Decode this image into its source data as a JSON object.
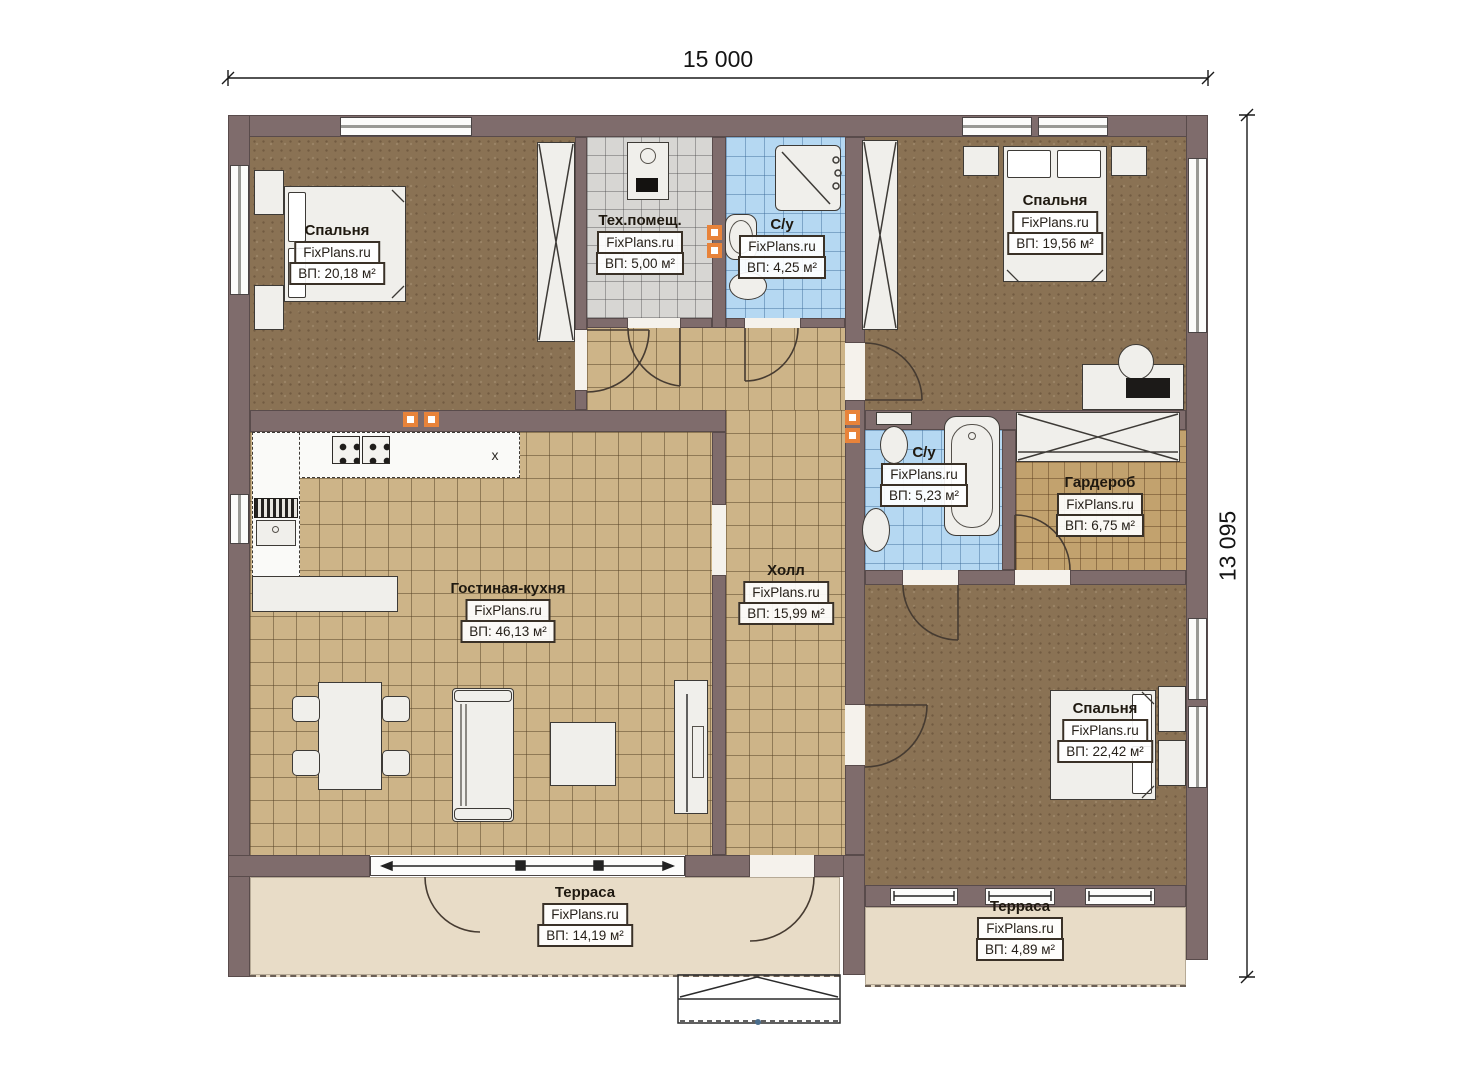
{
  "dimensions": {
    "width_label": "15 000",
    "height_label": "13 095"
  },
  "watermark": "FixPlans.ru",
  "kitchen": {
    "marker": "x"
  },
  "rooms": [
    {
      "key": "bedroom1",
      "name": "Спальня",
      "area": "ВП: 20,18 м²"
    },
    {
      "key": "tech",
      "name": "Тех.помещ.",
      "area": "ВП: 5,00 м²"
    },
    {
      "key": "bath1",
      "name": "С/у",
      "area": "ВП: 4,25 м²"
    },
    {
      "key": "bedroom2",
      "name": "Спальня",
      "area": "ВП: 19,56 м²"
    },
    {
      "key": "living",
      "name": "Гостиная-кухня",
      "area": "ВП: 46,13 м²"
    },
    {
      "key": "hall",
      "name": "Холл",
      "area": "ВП: 15,99 м²"
    },
    {
      "key": "bath2",
      "name": "С/у",
      "area": "ВП: 5,23 м²"
    },
    {
      "key": "wardrobe",
      "name": "Гардероб",
      "area": "ВП: 6,75 м²"
    },
    {
      "key": "bedroom3",
      "name": "Спальня",
      "area": "ВП: 22,42 м²"
    },
    {
      "key": "terrace1",
      "name": "Терраса",
      "area": "ВП: 14,19 м²"
    },
    {
      "key": "terrace2",
      "name": "Терраса",
      "area": "ВП: 4,89 м²"
    }
  ],
  "colors": {
    "wall": "#7f6c6c",
    "floorBrown": "#8a7254",
    "tileBeige": "#cdb488",
    "tileBlue": "#b5d8f2",
    "tileGray": "#d7d6d3",
    "tileTan": "#c2a26e",
    "terrace": "#e8dcc7",
    "accent": "#e8833a",
    "line": "#463b31"
  }
}
